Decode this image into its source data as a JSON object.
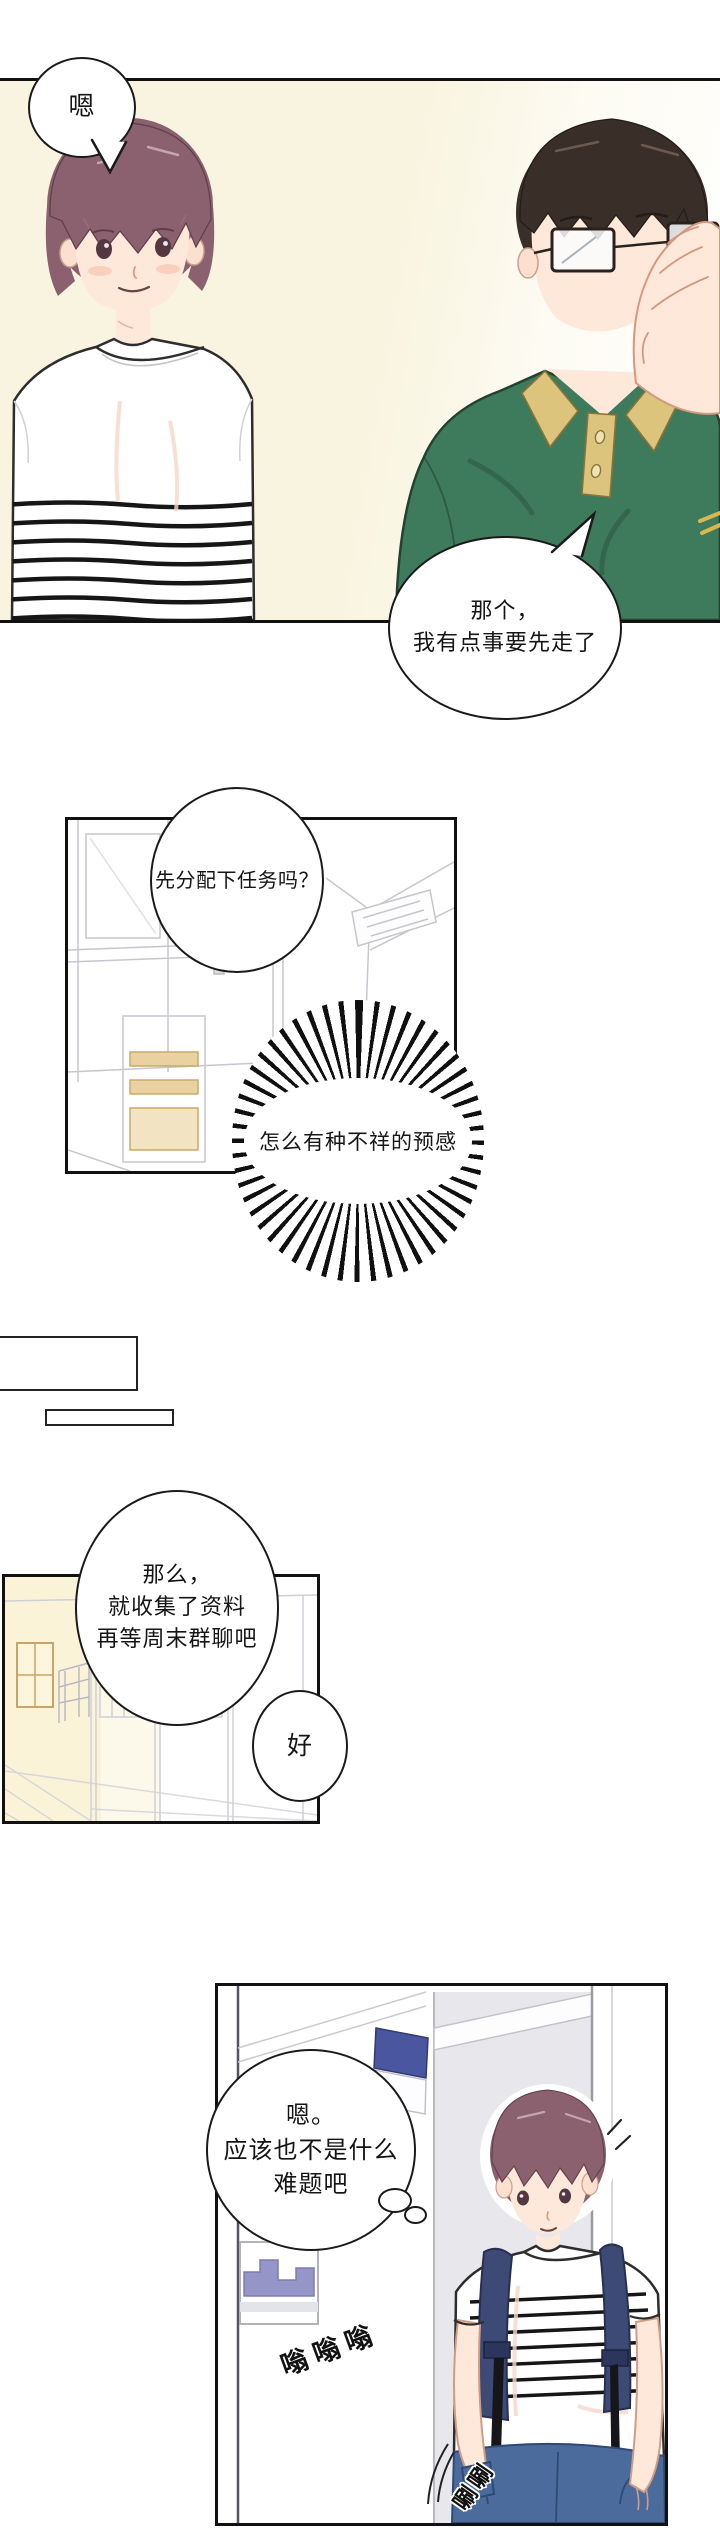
{
  "comic": {
    "panel1": {
      "bubble_hm": "嗯",
      "bubble_leave": [
        "那个，",
        "我有点事要先走了"
      ]
    },
    "panel2": {
      "bubble_assign": "先分配下任务吗？",
      "burst_premonition": "怎么有种不祥的预感"
    },
    "panel3": {
      "bubble_plan": [
        "那么，",
        "就收集了资料",
        "再等周末群聊吧"
      ],
      "bubble_ok": "好"
    },
    "panel4": {
      "thought": [
        "嗯。",
        "应该也不是什么",
        "难题吧"
      ],
      "sfx_buzz": "嗡嗡嗡",
      "sfx_swish": "唰唰"
    },
    "colors": {
      "panel_bg_cream": "#f8f4df",
      "polo_green": "#3e7a5c",
      "collar_yellow": "#dcc47c",
      "hair_brown": "#8b6170",
      "hair_black": "#3a2e28",
      "backpack_navy": "#3d4a75",
      "jeans_blue": "#4b6b9d",
      "sign_blue": "#4a56a0"
    }
  }
}
